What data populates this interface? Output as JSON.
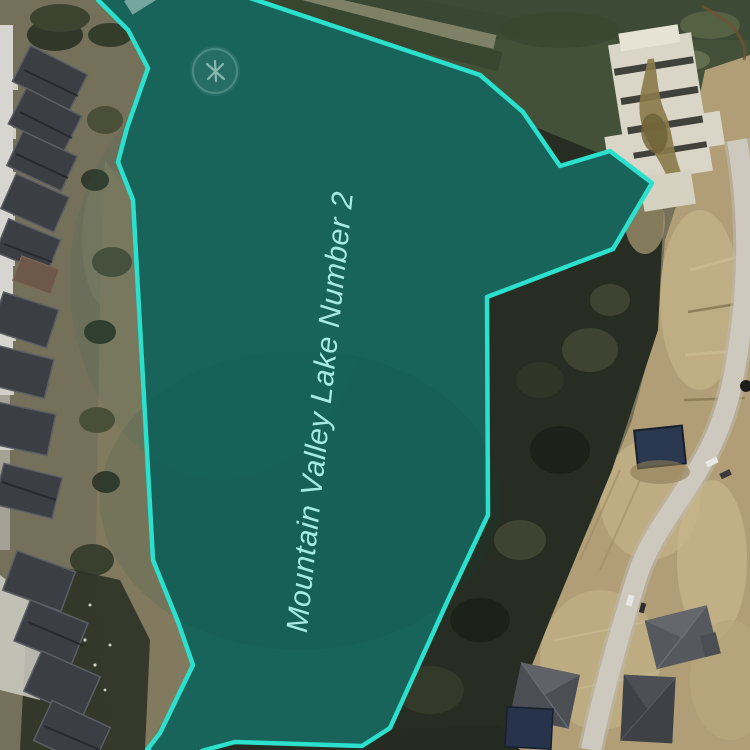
{
  "map": {
    "feature_label": "Mountain Valley Lake Number 2",
    "feature": {
      "fill_color": "#18635a",
      "stroke_color": "#2be0cd",
      "label_color": "#a6ebe3"
    }
  }
}
